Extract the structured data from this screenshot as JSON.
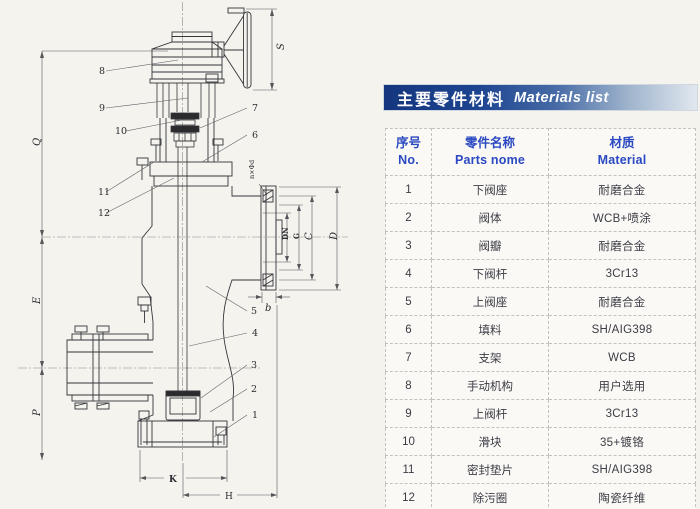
{
  "title_bar": {
    "text_zh": "主要零件材料",
    "text_en": "Materials list",
    "bg_dark": "#14367e",
    "bg_light": "#e2e8ef",
    "text_color": "#ffffff"
  },
  "table": {
    "header": {
      "col1_zh": "序号",
      "col1_en": "No.",
      "col2_zh": "零件名称",
      "col2_en": "Parts nome",
      "col3_zh": "材质",
      "col3_en": "Material",
      "text_color": "#2a49c2"
    },
    "rows": [
      {
        "no": "1",
        "part": "下阀座",
        "material": "耐磨合金"
      },
      {
        "no": "2",
        "part": "阀体",
        "material": "WCB+喷涂"
      },
      {
        "no": "3",
        "part": "阀瓣",
        "material": "耐磨合金"
      },
      {
        "no": "4",
        "part": "下阀杆",
        "material": "3Cr13"
      },
      {
        "no": "5",
        "part": "上阀座",
        "material": "耐磨合金"
      },
      {
        "no": "6",
        "part": "填料",
        "material": "SH/AIG398"
      },
      {
        "no": "7",
        "part": "支架",
        "material": "WCB"
      },
      {
        "no": "8",
        "part": "手动机构",
        "material": "用户选用"
      },
      {
        "no": "9",
        "part": "上阀杆",
        "material": "3Cr13"
      },
      {
        "no": "10",
        "part": "滑块",
        "material": "35+镀铬"
      },
      {
        "no": "11",
        "part": "密封垫片",
        "material": "SH/AIG398"
      },
      {
        "no": "12",
        "part": "除污圈",
        "material": "陶瓷纤维"
      }
    ]
  },
  "diagram": {
    "callouts": [
      "1",
      "2",
      "3",
      "4",
      "5",
      "6",
      "7",
      "8",
      "9",
      "10",
      "11",
      "12"
    ],
    "dims": {
      "Q": "Q",
      "E": "E",
      "P": "P",
      "S": "S",
      "DN": "DN",
      "G": "G",
      "C": "C",
      "D": "D",
      "b": "b",
      "K": "K",
      "H": "H",
      "bolt_note": "n×Φd"
    }
  }
}
